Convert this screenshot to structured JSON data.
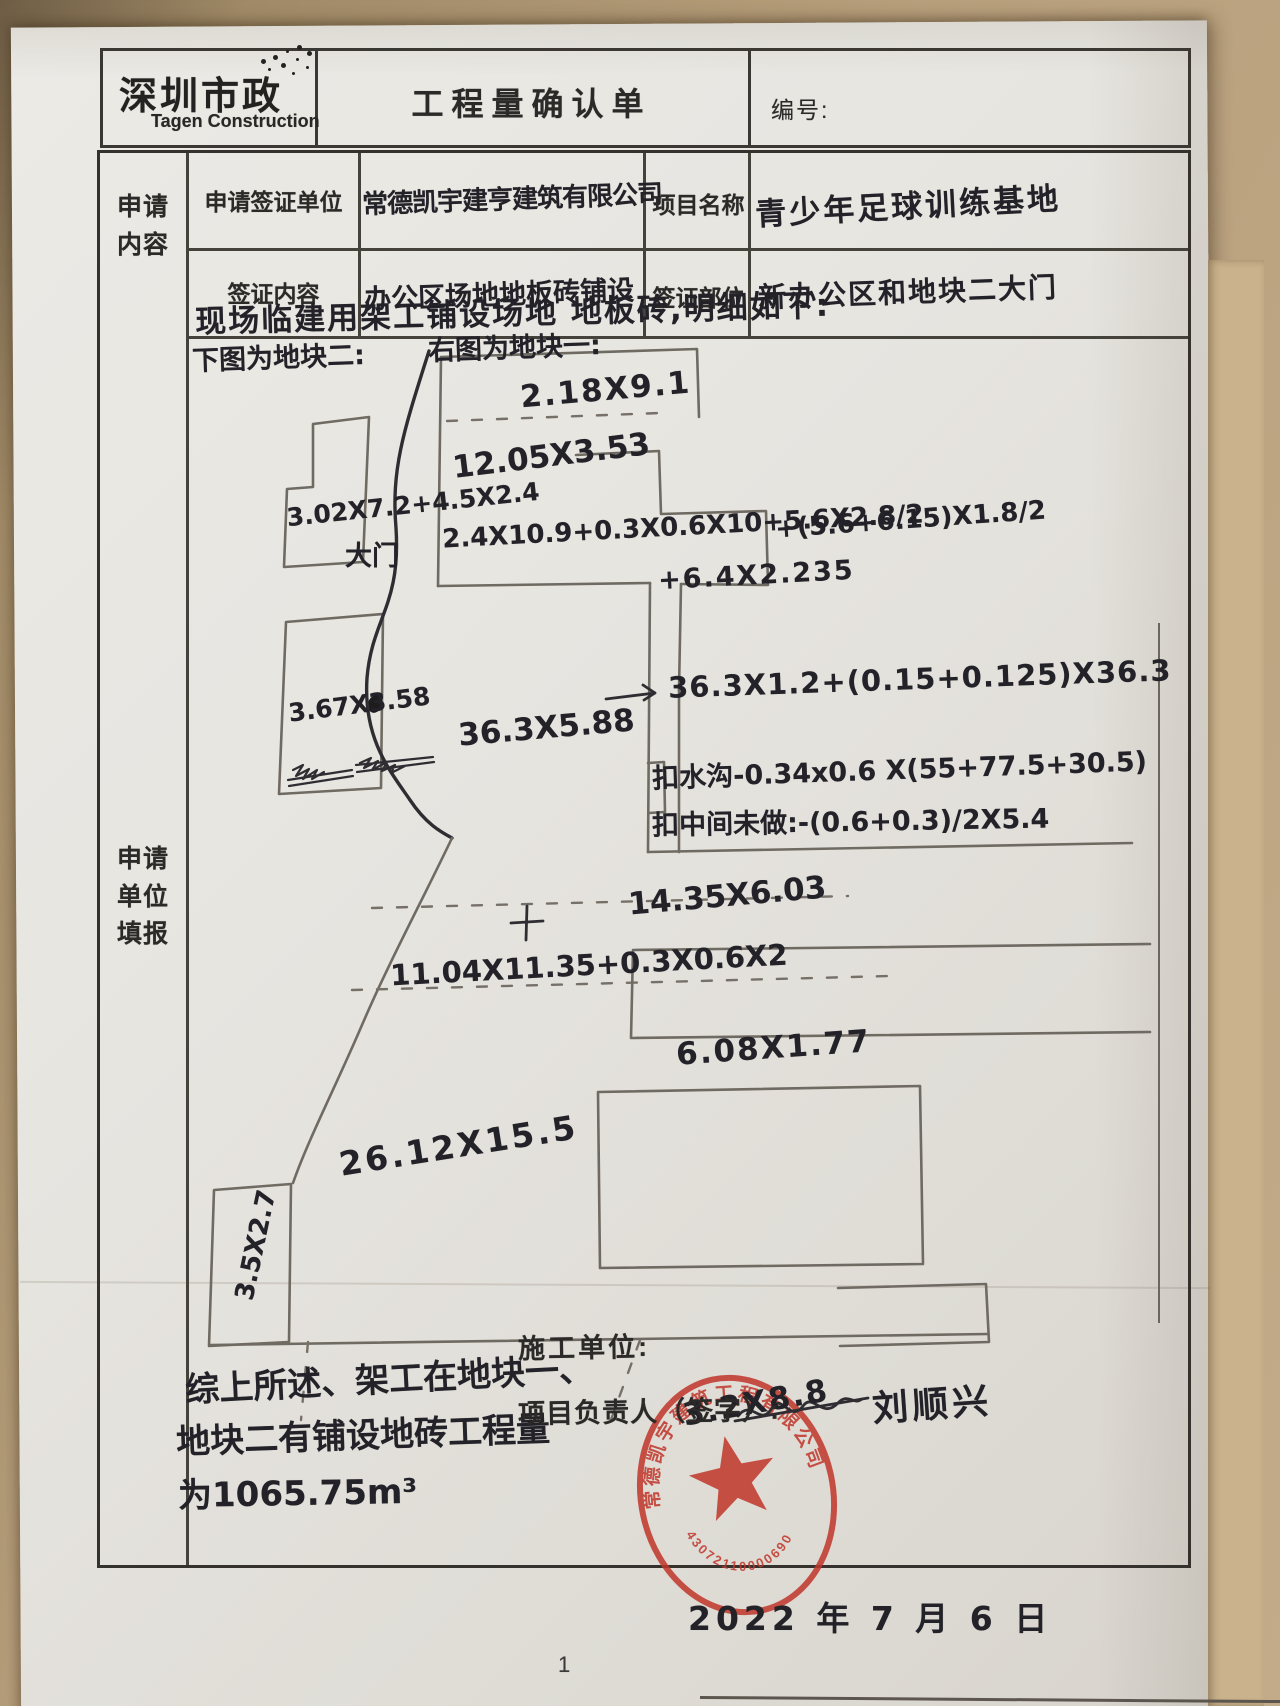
{
  "page": {
    "page_number": "1"
  },
  "header": {
    "logo_title": "深圳市政",
    "logo_subtitle": "Tagen Construction",
    "form_title": "工程量确认单",
    "serial_label": "编号:"
  },
  "left_labels": {
    "section1": "申请\n内容",
    "section2": "申请\n单位\n填报"
  },
  "fields": {
    "row1": {
      "label1": "申请签证单位",
      "value1": "常德凯宇建亨建筑有限公司",
      "label2": "项目名称",
      "value2": "青少年足球训练基地"
    },
    "row2": {
      "label1": "签证内容",
      "value1": "办公区场地地板砖铺设",
      "label2": "签证部位",
      "value2": "新办公区和地块二大门"
    }
  },
  "body": {
    "intro": "现场临建用架工铺设场地 地板砖,明细如下:",
    "left_caption": "下图为地块二:",
    "right_caption": "右图为地块一:",
    "gate_label": "大门",
    "measurements": {
      "block1_top": "2.18X9.1",
      "block1_r2": "12.05X3.53",
      "block1_formula1": "2.4X10.9+0.3X0.6X10+5.6X2.8/2",
      "block1_formula1b": "+(5.6+6.15)X1.8/2",
      "block1_formula1c": "+6.4X2.235",
      "block1_arrow_formula": "36.3X1.2+(0.15+0.125)X36.3",
      "block1_strip": "36.3X5.88",
      "deduct_gutter": "扣水沟-0.34x0.6 X(55+77.5+30.5)",
      "deduct_middle": "扣中间未做:-(0.6+0.3)/2X5.4",
      "block1_r3": "14.35X6.03",
      "block1_r4": "11.04X11.35+0.3X0.6X2",
      "block1_r5": "6.08X1.77",
      "block1_big": "26.12X15.5",
      "block1_side": "3.5X2.7",
      "block1_stamped": "3.2X8.8",
      "block2_shape1": "3.02X7.2+4.5X2.4",
      "block2_shape2": "3.67X3.58"
    },
    "summary_line1": "综上所述、架工在地块一、",
    "summary_line2": "地块二有铺设地砖工程量",
    "summary_line3": "为1065.75m³"
  },
  "footer": {
    "contractor_label": "施工单位:",
    "manager_label": "项目负责人（签字）:",
    "signature": "刘顺兴",
    "date": "2022 年 7 月 6 日"
  },
  "stamp": {
    "company": "常德凯宇建筑工程有限公司",
    "number": "43072110000690",
    "color": "#c0362b"
  }
}
